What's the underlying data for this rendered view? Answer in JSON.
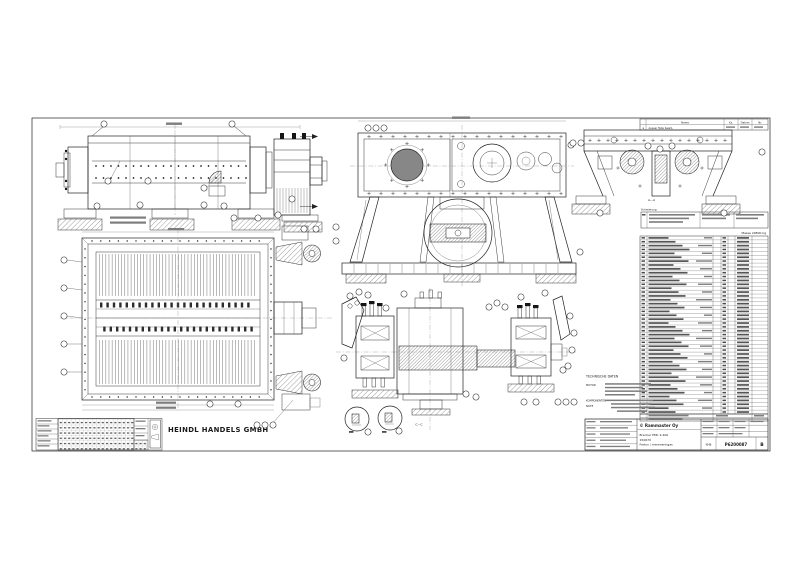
{
  "sheet": {
    "company": "HEINDL HANDELS GMBH",
    "accent_blue": "#3d4fa5"
  },
  "revision_table": {
    "col_name": "Name",
    "col_kz": "Kz.",
    "col_datum": "Datum",
    "col_nr": "Nr.",
    "rev": "a",
    "change_text": "Ausser Teile bearb."
  },
  "sections": {
    "aa": "A—A",
    "cc": "C—C"
  },
  "lubrication_label": "Schmierung",
  "mass_note": "Masse 29800 kg",
  "notes": {
    "heading": "TECHNISCHE DATEN",
    "motor": "MOTOR",
    "komponenten": "KOMPONENTEN",
    "note": "NOTE"
  },
  "parts_list": {
    "row_count": 46
  },
  "title_block": {
    "manufacturer": "© Rammaster Oy",
    "product": "Brecher PMC 2-400",
    "order_no": "150670",
    "subtitle": "Fartun / mereneringas",
    "code": "KHB",
    "drawing_number": "P6200087",
    "revision": "B"
  }
}
